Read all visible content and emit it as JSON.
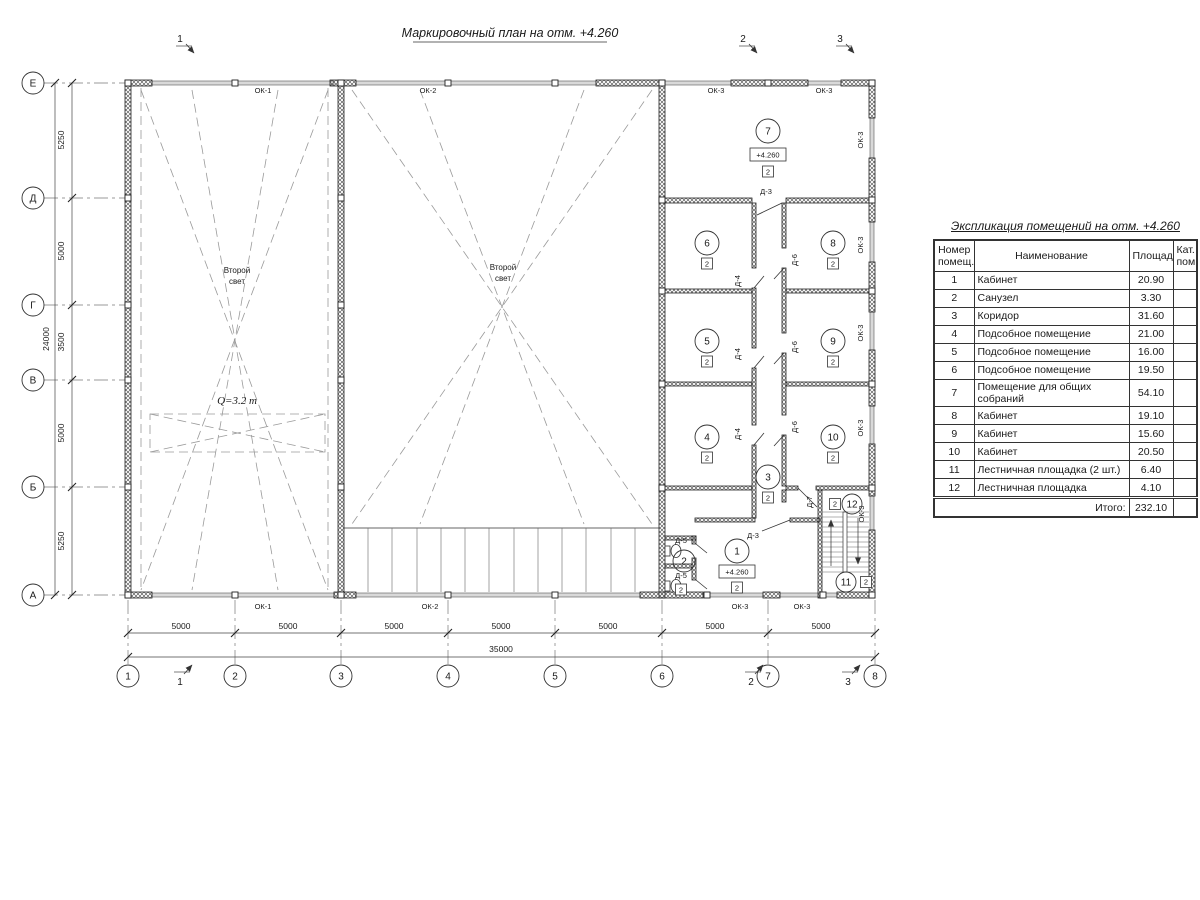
{
  "plan": {
    "title": "Маркировочный план на отм. +4.260",
    "second_light_line1": "Второй",
    "second_light_line2": "свет",
    "crane_label": "Q=3.2 т",
    "elevation_label": "+4.260",
    "cat_label": "2",
    "axes_bottom": [
      "1",
      "2",
      "3",
      "4",
      "5",
      "6",
      "7",
      "8"
    ],
    "axes_left": [
      "Е",
      "Д",
      "Г",
      "В",
      "Б",
      "А"
    ],
    "dims_left": [
      "5250",
      "5000",
      "3500",
      "5000",
      "5250"
    ],
    "dim_left_total": "24000",
    "dims_bottom": [
      "5000",
      "5000",
      "5000",
      "5000",
      "5000",
      "5000",
      "5000"
    ],
    "dim_bottom_total": "35000",
    "section_marks": [
      "1",
      "2",
      "3"
    ],
    "room_numbers": [
      "1",
      "2",
      "3",
      "4",
      "5",
      "6",
      "7",
      "8",
      "9",
      "10",
      "11",
      "12"
    ],
    "window_labels": {
      "ok1": "ОК-1",
      "ok2": "ОК-2",
      "ok3": "ОК-3"
    },
    "door_labels": {
      "d3": "Д-3",
      "d4": "Д-4",
      "d5": "Д-5",
      "d6": "Д-6",
      "d7": "Д-7"
    }
  },
  "table": {
    "title": "Экспликация помещений на отм. +4.260",
    "headers": {
      "num": "Номер помещ.",
      "name": "Наименование",
      "area": "Площадь",
      "cat": "Кат. пом."
    },
    "rows": [
      {
        "num": "1",
        "name": "Кабинет",
        "area": "20.90"
      },
      {
        "num": "2",
        "name": "Санузел",
        "area": "3.30"
      },
      {
        "num": "3",
        "name": "Коридор",
        "area": "31.60"
      },
      {
        "num": "4",
        "name": "Подсобное помещение",
        "area": "21.00"
      },
      {
        "num": "5",
        "name": "Подсобное помещение",
        "area": "16.00"
      },
      {
        "num": "6",
        "name": "Подсобное помещение",
        "area": "19.50"
      },
      {
        "num": "7",
        "name": "Помещение для общих собраний",
        "area": "54.10"
      },
      {
        "num": "8",
        "name": "Кабинет",
        "area": "19.10"
      },
      {
        "num": "9",
        "name": "Кабинет",
        "area": "15.60"
      },
      {
        "num": "10",
        "name": "Кабинет",
        "area": "20.50"
      },
      {
        "num": "11",
        "name": "Лестничная площадка (2 шт.)",
        "area": "6.40"
      },
      {
        "num": "12",
        "name": "Лестничная площадка",
        "area": "4.10"
      }
    ],
    "total_label": "Итого:",
    "total_value": "232.10"
  }
}
